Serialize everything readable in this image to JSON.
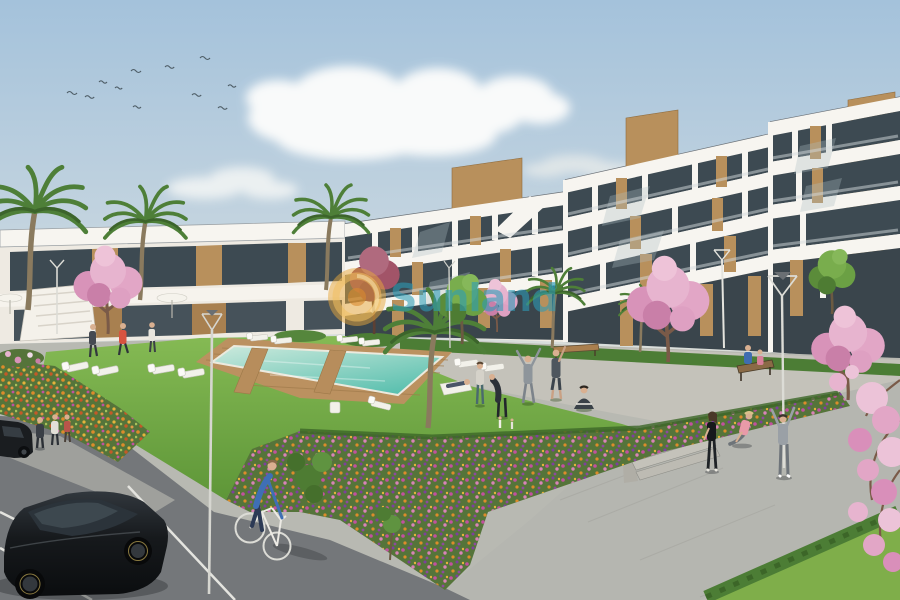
{
  "watermark": {
    "brand": "Sunland",
    "mark": "®",
    "text_color": "#2d9cb7",
    "logo_color": "#e7a83b",
    "logo_ring_color": "#f0c060",
    "logo_core_color": "#d98a2e"
  },
  "palette": {
    "sky_top": "#a4c2db",
    "sky_mid": "#c9d7e0",
    "sky_horizon": "#ece5d7",
    "cloud_white": "#fdfdfc",
    "building_white": "#f7f5f0",
    "building_shadow": "#e6e1d8",
    "glazing_dark": "#3d4a52",
    "wood_panel": "#b8905c",
    "stone_clad": "#c8a36a",
    "grass_light": "#85ba54",
    "grass_deep": "#5e9638",
    "hedge_green": "#4c7d35",
    "pool_shallow": "#cdeadd",
    "pool_deep": "#58bfae",
    "pool_deck": "#bb9160",
    "blossom_pink": "#e2a6c6",
    "blossom_deep": "#c97fa8",
    "flower_orange": "#dd8c2b",
    "flower_gold": "#e6b33c",
    "flower_magenta": "#c2519f",
    "flower_purple": "#7e3f9e",
    "asphalt": "#74777a",
    "paver_dark": "#64676a",
    "concrete_path": "#b5b6b0",
    "lamp_white": "#e4e4de",
    "car_black": "#141619"
  }
}
